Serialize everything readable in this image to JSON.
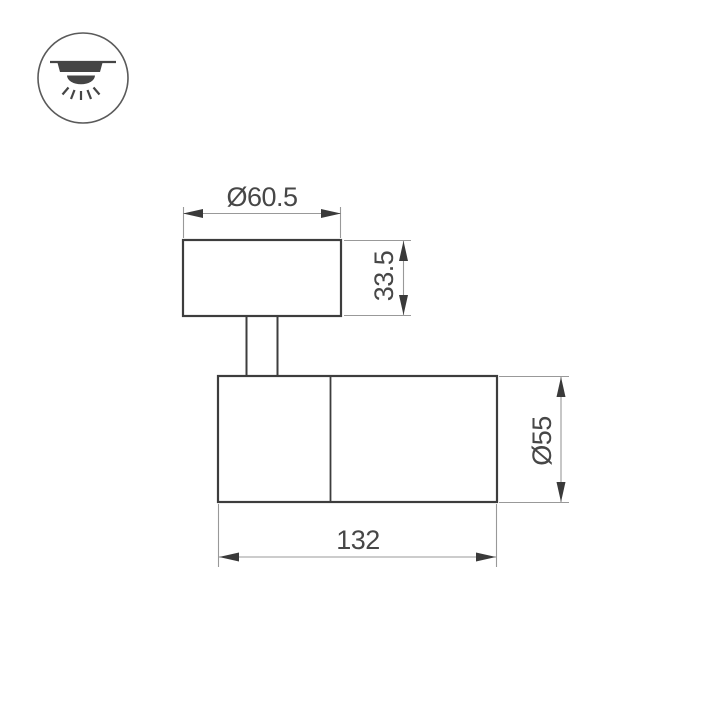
{
  "icon": {
    "name": "recessed-downlight-icon"
  },
  "drawing": {
    "type": "technical-dimension-drawing",
    "subject": "surface-mounted spot light fixture, side view",
    "labels": {
      "canopy_diameter": "Ø60.5",
      "canopy_height": "33.5",
      "body_diameter": "Ø55",
      "body_length": "132"
    },
    "colors": {
      "outline": "#3d3d3d",
      "dimension_lines": "#999999",
      "dimension_text": "#474747",
      "icon": "#454545",
      "background": "#ffffff"
    }
  }
}
